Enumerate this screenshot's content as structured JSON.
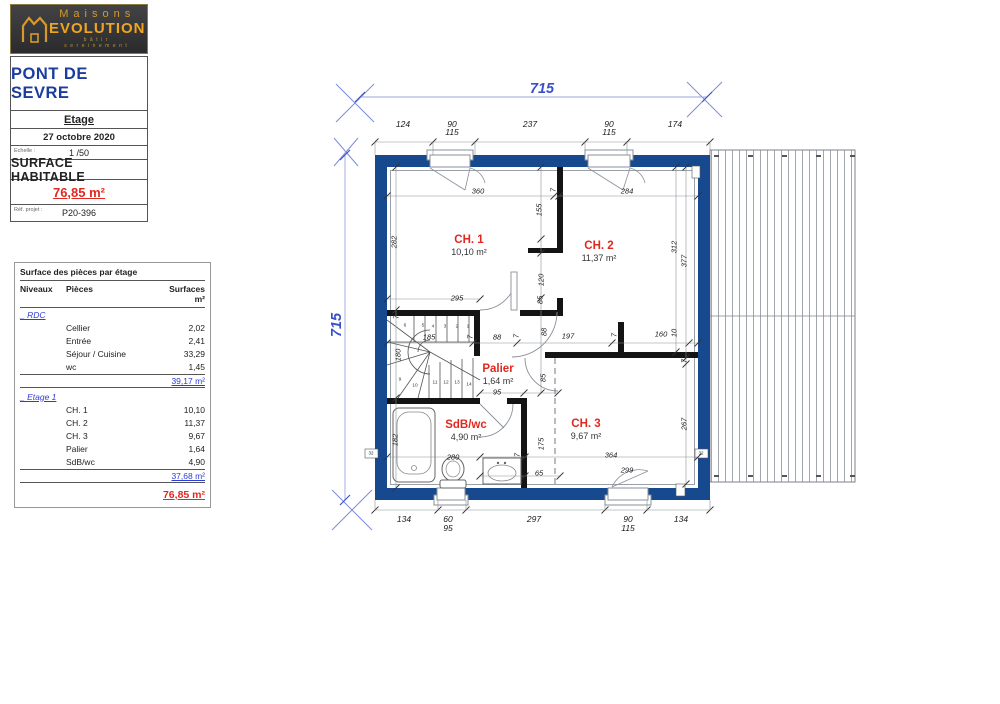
{
  "logo": {
    "brand_top": "Maisons",
    "brand_bottom": "EVOLUTION",
    "tagline": "bâtir sereinement"
  },
  "title_block": {
    "project": "PONT DE SEVRE",
    "floor": "Etage",
    "date": "27 octobre 2020",
    "scale_label": "Echelle :",
    "scale": "1 /50",
    "surface_label": "SURFACE HABITABLE",
    "surface_value": "76,85 m²",
    "ref_label": "Réf. projet :",
    "ref_value": "P20-396"
  },
  "areas_table": {
    "title": "Surface des pièces par étage",
    "headers": [
      "Niveaux",
      "Pièces",
      "Surfaces m²"
    ],
    "sections": [
      {
        "level": "_ RDC",
        "rows": [
          [
            "Cellier",
            "2,02"
          ],
          [
            "Entrée",
            "2,41"
          ],
          [
            "Séjour / Cuisine",
            "33,29"
          ],
          [
            "wc",
            "1,45"
          ]
        ],
        "subtotal": "39,17 m²"
      },
      {
        "level": "_ Etage 1",
        "rows": [
          [
            "CH. 1",
            "10,10"
          ],
          [
            "CH. 2",
            "11,37"
          ],
          [
            "CH. 3",
            "9,67"
          ],
          [
            "Palier",
            "1,64"
          ],
          [
            "SdB/wc",
            "4,90"
          ]
        ],
        "subtotal": "37,68 m²"
      }
    ],
    "total": "76,85 m²"
  },
  "plan": {
    "total_width_label": "715",
    "total_height_label": "715",
    "rooms": [
      {
        "name": "CH. 1",
        "area": "10,10 m²",
        "x": 139,
        "y": 166
      },
      {
        "name": "CH. 2",
        "area": "11,37 m²",
        "x": 269,
        "y": 172
      },
      {
        "name": "Palier",
        "area": "1,64 m²",
        "x": 168,
        "y": 295
      },
      {
        "name": "SdB/wc",
        "area": "4,90 m²",
        "x": 136,
        "y": 351
      },
      {
        "name": "CH. 3",
        "area": "9,67 m²",
        "x": 256,
        "y": 350
      }
    ],
    "dim_labels": [
      {
        "t": "124",
        "x": 73,
        "y": 44,
        "b": 1
      },
      {
        "t": "90",
        "x": 122,
        "y": 44,
        "b": 1
      },
      {
        "t": "115",
        "x": 122,
        "y": 52,
        "b": 1
      },
      {
        "t": "237",
        "x": 200,
        "y": 44,
        "b": 1
      },
      {
        "t": "90",
        "x": 279,
        "y": 44,
        "b": 1
      },
      {
        "t": "115",
        "x": 279,
        "y": 52,
        "b": 1
      },
      {
        "t": "174",
        "x": 345,
        "y": 44,
        "b": 1
      },
      {
        "t": "134",
        "x": 74,
        "y": 439,
        "b": 1
      },
      {
        "t": "60",
        "x": 118,
        "y": 439,
        "b": 1
      },
      {
        "t": "95",
        "x": 118,
        "y": 448,
        "b": 1
      },
      {
        "t": "297",
        "x": 204,
        "y": 439,
        "b": 1
      },
      {
        "t": "90",
        "x": 298,
        "y": 439,
        "b": 1
      },
      {
        "t": "115",
        "x": 298,
        "y": 448,
        "b": 1
      },
      {
        "t": "134",
        "x": 351,
        "y": 439,
        "b": 1
      },
      {
        "t": "360",
        "x": 148,
        "y": 111
      },
      {
        "t": "7",
        "x": 223,
        "y": 110,
        "r": 1
      },
      {
        "t": "284",
        "x": 297,
        "y": 111
      },
      {
        "t": "282",
        "x": 64,
        "y": 162,
        "r": 1
      },
      {
        "t": "155",
        "x": 209,
        "y": 130,
        "r": 1
      },
      {
        "t": "7",
        "x": 211,
        "y": 172,
        "r": 1
      },
      {
        "t": "120",
        "x": 211,
        "y": 200,
        "r": 1
      },
      {
        "t": "85",
        "x": 210,
        "y": 220,
        "r": 1
      },
      {
        "t": "295",
        "x": 127,
        "y": 218
      },
      {
        "t": "312",
        "x": 344,
        "y": 167,
        "r": 1
      },
      {
        "t": "377",
        "x": 354,
        "y": 181,
        "r": 1
      },
      {
        "t": "7",
        "x": 66,
        "y": 237,
        "r": 1
      },
      {
        "t": "185",
        "x": 99,
        "y": 257
      },
      {
        "t": "7",
        "x": 140,
        "y": 257,
        "r": 1
      },
      {
        "t": "88",
        "x": 167,
        "y": 257
      },
      {
        "t": "7",
        "x": 186,
        "y": 256,
        "r": 1
      },
      {
        "t": "197",
        "x": 238,
        "y": 256
      },
      {
        "t": "7",
        "x": 284,
        "y": 255,
        "r": 1
      },
      {
        "t": "160",
        "x": 331,
        "y": 254
      },
      {
        "t": "10",
        "x": 344,
        "y": 253,
        "r": 1
      },
      {
        "t": "180",
        "x": 68,
        "y": 275,
        "r": 1
      },
      {
        "t": "88",
        "x": 214,
        "y": 252,
        "r": 1
      },
      {
        "t": "85",
        "x": 213,
        "y": 298,
        "r": 1
      },
      {
        "t": "95",
        "x": 167,
        "y": 312
      },
      {
        "t": "182",
        "x": 65,
        "y": 360,
        "r": 1
      },
      {
        "t": "280",
        "x": 123,
        "y": 377
      },
      {
        "t": "7",
        "x": 187,
        "y": 375,
        "r": 1
      },
      {
        "t": "175",
        "x": 211,
        "y": 364,
        "r": 1
      },
      {
        "t": "65",
        "x": 209,
        "y": 393
      },
      {
        "t": "364",
        "x": 281,
        "y": 375
      },
      {
        "t": "299",
        "x": 297,
        "y": 390
      },
      {
        "t": "267",
        "x": 354,
        "y": 344,
        "r": 1
      },
      {
        "t": "7",
        "x": 354,
        "y": 281,
        "r": 1
      },
      {
        "t": "32",
        "x": 41,
        "y": 373,
        "tiny": 1
      },
      {
        "t": "32",
        "x": 371,
        "y": 373,
        "tiny": 1
      }
    ],
    "stair_numbers": [
      {
        "t": "1",
        "x": 138,
        "y": 247
      },
      {
        "t": "2",
        "x": 127,
        "y": 247
      },
      {
        "t": "3",
        "x": 115,
        "y": 247
      },
      {
        "t": "4",
        "x": 103,
        "y": 247
      },
      {
        "t": "5",
        "x": 93,
        "y": 246
      },
      {
        "t": "6",
        "x": 75,
        "y": 246
      },
      {
        "t": "9",
        "x": 70,
        "y": 300
      },
      {
        "t": "10",
        "x": 85,
        "y": 306
      },
      {
        "t": "11",
        "x": 105,
        "y": 303
      },
      {
        "t": "12",
        "x": 116,
        "y": 303
      },
      {
        "t": "13",
        "x": 127,
        "y": 303
      },
      {
        "t": "14",
        "x": 139,
        "y": 305
      }
    ],
    "colors": {
      "wall": "#17498f",
      "accent_blue": "#3a51c6",
      "room_red": "#e02820",
      "logo_gold": "#f0a51e"
    }
  }
}
